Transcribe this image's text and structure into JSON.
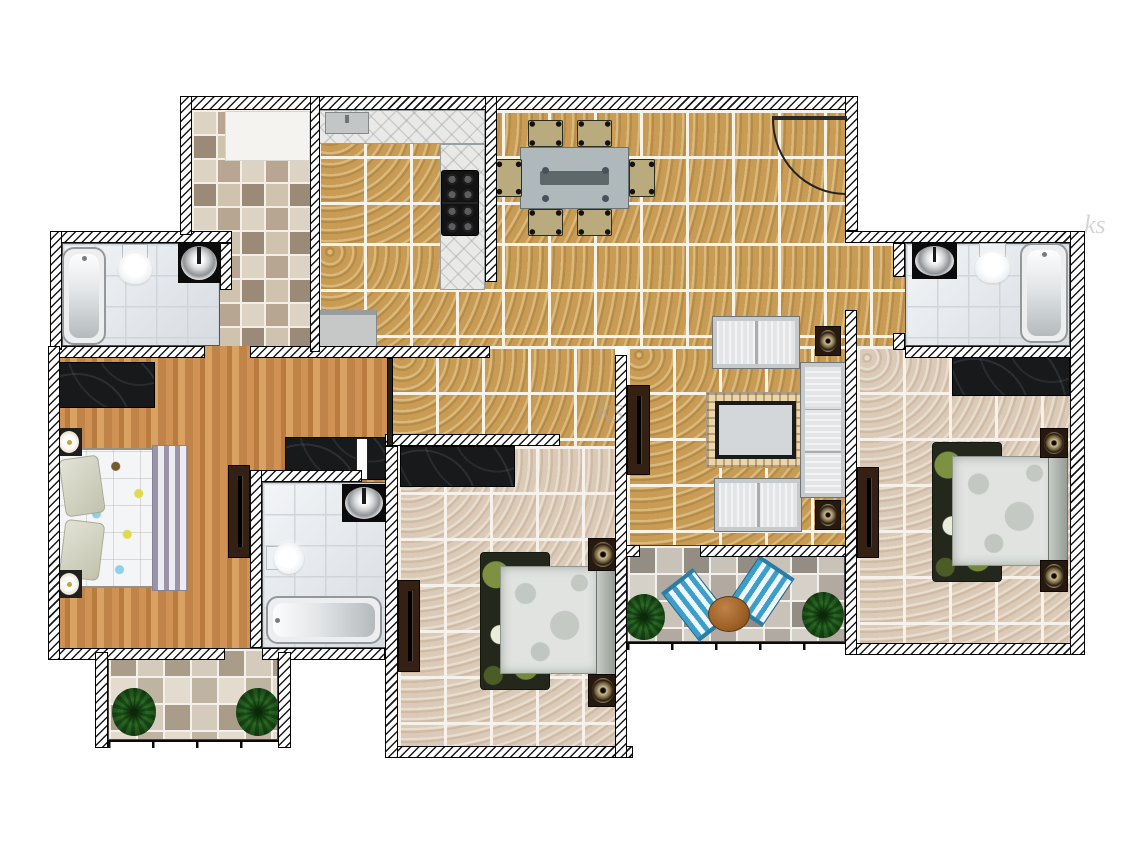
{
  "title": "apartment-floor-plan",
  "canvas": {
    "width": 1128,
    "height": 855,
    "background": "#ffffff"
  },
  "palette": {
    "tan_tile": "#c89c55",
    "beige_tile": "#dbcab7",
    "wood_floor": "#c08448",
    "bath_tile": "#e8ebee",
    "wall_black": "#000000",
    "rug_dark": "#17191b",
    "sofa_grey": "#c7cacc",
    "chair_khaki": "#b9ab7d",
    "lounge_blue": "#3c9ecb",
    "carpet_border_tan": "#ead6aa",
    "plant_green": "#2c6e27",
    "table_brown": "#9c5f27"
  },
  "watermarks": [
    {
      "text": "ks",
      "x": 596,
      "y": 392,
      "size": 34
    },
    {
      "text": "ks",
      "x": 1084,
      "y": 210,
      "size": 26
    }
  ],
  "elements": [
    {
      "n": "floor-foyer",
      "t": "mosaic-warm",
      "x": 192,
      "y": 110,
      "w": 118,
      "h": 236
    },
    {
      "n": "floor-kitchen-dining",
      "t": "tan",
      "x": 318,
      "y": 110,
      "w": 527,
      "h": 133
    },
    {
      "n": "floor-hallway-upper",
      "t": "tan",
      "x": 318,
      "y": 243,
      "w": 587,
      "h": 103
    },
    {
      "n": "floor-living-room",
      "t": "tan",
      "x": 627,
      "y": 346,
      "w": 218,
      "h": 199
    },
    {
      "n": "floor-corridor",
      "t": "tan",
      "x": 390,
      "y": 346,
      "w": 225,
      "h": 100
    },
    {
      "n": "floor-master-bedroom",
      "t": "wood",
      "x": 58,
      "y": 346,
      "w": 330,
      "h": 302
    },
    {
      "n": "floor-bathroom-left",
      "t": "bathtile",
      "x": 62,
      "y": 243,
      "w": 158,
      "h": 103
    },
    {
      "n": "floor-bathroom-ensuite",
      "t": "bathtile",
      "x": 262,
      "y": 482,
      "w": 126,
      "h": 166
    },
    {
      "n": "floor-bathroom-right",
      "t": "bathtile",
      "x": 905,
      "y": 243,
      "w": 165,
      "h": 103
    },
    {
      "n": "floor-bedroom-2",
      "t": "beige",
      "x": 398,
      "y": 446,
      "w": 217,
      "h": 300
    },
    {
      "n": "floor-bedroom-3",
      "t": "beige",
      "x": 857,
      "y": 346,
      "w": 213,
      "h": 297
    },
    {
      "n": "floor-balcony-left",
      "t": "mosaic-beige",
      "x": 108,
      "y": 648,
      "w": 170,
      "h": 92
    },
    {
      "n": "floor-balcony-center",
      "t": "mosaic-grey",
      "x": 627,
      "y": 545,
      "w": 218,
      "h": 97
    },
    {
      "n": "entrance-doormat",
      "t": "mat",
      "x": 225,
      "y": 111,
      "w": 85,
      "h": 50
    },
    {
      "n": "rug-master-bedroom",
      "t": "rug-dark",
      "x": 58,
      "y": 362,
      "w": 97,
      "h": 46
    },
    {
      "n": "rug-hallway",
      "t": "rug-dark",
      "x": 285,
      "y": 437,
      "w": 103,
      "h": 43
    },
    {
      "n": "rug-bedroom-2",
      "t": "rug-dark",
      "x": 400,
      "y": 446,
      "w": 115,
      "h": 41
    },
    {
      "n": "rug-bedroom-3",
      "t": "rug-dark",
      "x": 952,
      "y": 356,
      "w": 118,
      "h": 40
    },
    {
      "n": "carpet-bedroom-2",
      "t": "carpet-olive",
      "x": 480,
      "y": 552,
      "w": 70,
      "h": 138
    },
    {
      "n": "carpet-bedroom-3",
      "t": "carpet-olive",
      "x": 932,
      "y": 442,
      "w": 70,
      "h": 140
    },
    {
      "n": "carpet-living-room",
      "t": "carpet-greek",
      "x": 706,
      "y": 392,
      "w": 99,
      "h": 76
    },
    {
      "n": "kitchen-counter-top",
      "t": "counter",
      "x": 318,
      "y": 110,
      "w": 167,
      "h": 34
    },
    {
      "n": "kitchen-counter-right",
      "t": "counter",
      "x": 440,
      "y": 144,
      "w": 45,
      "h": 146
    },
    {
      "n": "gas-stove",
      "t": "stove",
      "x": 441,
      "y": 170,
      "w": 38,
      "h": 66
    },
    {
      "n": "kitchen-sink",
      "t": "sink-grey",
      "x": 325,
      "y": 112,
      "w": 44,
      "h": 22
    },
    {
      "n": "refrigerator",
      "t": "fridge",
      "x": 318,
      "y": 310,
      "w": 59,
      "h": 40
    },
    {
      "n": "dining-table",
      "t": "table-grey",
      "x": 520,
      "y": 147,
      "w": 109,
      "h": 62
    },
    {
      "n": "dining-chair-1",
      "t": "chair",
      "x": 528,
      "y": 120,
      "w": 35,
      "h": 27
    },
    {
      "n": "dining-chair-2",
      "t": "chair",
      "x": 577,
      "y": 120,
      "w": 35,
      "h": 27
    },
    {
      "n": "dining-chair-3",
      "t": "chair",
      "x": 528,
      "y": 209,
      "w": 35,
      "h": 27
    },
    {
      "n": "dining-chair-4",
      "t": "chair",
      "x": 577,
      "y": 209,
      "w": 35,
      "h": 27
    },
    {
      "n": "dining-chair-5",
      "t": "chair",
      "x": 496,
      "y": 159,
      "w": 26,
      "h": 38
    },
    {
      "n": "dining-chair-6",
      "t": "chair",
      "x": 629,
      "y": 159,
      "w": 26,
      "h": 38
    },
    {
      "n": "sofa-two-seater-top",
      "t": "sofa-h",
      "x": 712,
      "y": 316,
      "w": 88,
      "h": 53
    },
    {
      "n": "sofa-two-seater-bottom",
      "t": "sofa-h",
      "x": 714,
      "y": 478,
      "w": 88,
      "h": 54
    },
    {
      "n": "sofa-three-seater",
      "t": "sofa-v",
      "x": 800,
      "y": 362,
      "w": 46,
      "h": 136
    },
    {
      "n": "side-table-top",
      "t": "speaker-box",
      "x": 815,
      "y": 326,
      "w": 26,
      "h": 30
    },
    {
      "n": "side-table-bottom",
      "t": "speaker-box",
      "x": 815,
      "y": 500,
      "w": 26,
      "h": 30
    },
    {
      "n": "tv-unit-living-room",
      "t": "tvunit-v",
      "x": 627,
      "y": 385,
      "w": 23,
      "h": 90
    },
    {
      "n": "master-bed",
      "t": "bed-master",
      "x": 58,
      "y": 448,
      "w": 100,
      "h": 140
    },
    {
      "n": "master-bed-runner",
      "t": "runner-stripes",
      "x": 152,
      "y": 445,
      "w": 36,
      "h": 146
    },
    {
      "n": "master-bed-pillows",
      "t": "pillow-master",
      "x": 60,
      "y": 455,
      "w": 46,
      "h": 126
    },
    {
      "n": "wall-lamp-top",
      "t": "lamp-round",
      "x": 56,
      "y": 428,
      "w": 26,
      "h": 28
    },
    {
      "n": "wall-lamp-bottom",
      "t": "lamp-round",
      "x": 56,
      "y": 570,
      "w": 26,
      "h": 28
    },
    {
      "n": "wardrobe-master",
      "t": "tvunit-v",
      "x": 228,
      "y": 465,
      "w": 22,
      "h": 93
    },
    {
      "n": "bed-2",
      "t": "bed-grey",
      "x": 500,
      "y": 566,
      "w": 100,
      "h": 108
    },
    {
      "n": "headboard-bed-2",
      "t": "headboard-v",
      "x": 596,
      "y": 560,
      "w": 20,
      "h": 118
    },
    {
      "n": "nightstand-bed2-top",
      "t": "speaker-box",
      "x": 588,
      "y": 538,
      "w": 30,
      "h": 33
    },
    {
      "n": "nightstand-bed2-bottom",
      "t": "speaker-box",
      "x": 588,
      "y": 674,
      "w": 30,
      "h": 33
    },
    {
      "n": "wardrobe-bedroom-2",
      "t": "tvunit-v",
      "x": 398,
      "y": 580,
      "w": 22,
      "h": 92
    },
    {
      "n": "bed-3",
      "t": "bed-grey",
      "x": 952,
      "y": 456,
      "w": 104,
      "h": 110
    },
    {
      "n": "headboard-bed-3",
      "t": "headboard-v",
      "x": 1048,
      "y": 452,
      "w": 20,
      "h": 118
    },
    {
      "n": "nightstand-bed3-top",
      "t": "speaker-box",
      "x": 1040,
      "y": 428,
      "w": 28,
      "h": 30
    },
    {
      "n": "nightstand-bed3-bottom",
      "t": "speaker-box",
      "x": 1040,
      "y": 560,
      "w": 28,
      "h": 32
    },
    {
      "n": "wardrobe-bedroom-3",
      "t": "tvunit-v",
      "x": 857,
      "y": 467,
      "w": 22,
      "h": 91
    },
    {
      "n": "bathtub-left",
      "t": "tub-v",
      "x": 62,
      "y": 247,
      "w": 44,
      "h": 98
    },
    {
      "n": "toilet-left",
      "t": "toilet-v",
      "x": 118,
      "y": 244,
      "w": 34,
      "h": 40
    },
    {
      "n": "washbasin-left",
      "t": "sink-sq",
      "x": 178,
      "y": 243,
      "w": 42,
      "h": 40
    },
    {
      "n": "toilet-ensuite",
      "t": "toilet-h",
      "x": 266,
      "y": 542,
      "w": 38,
      "h": 32
    },
    {
      "n": "bathtub-ensuite",
      "t": "tub-h",
      "x": 266,
      "y": 596,
      "w": 116,
      "h": 48
    },
    {
      "n": "washbasin-ensuite",
      "t": "sink-sq",
      "x": 342,
      "y": 484,
      "w": 44,
      "h": 38
    },
    {
      "n": "washbasin-right",
      "t": "sink-sq",
      "x": 912,
      "y": 243,
      "w": 45,
      "h": 36
    },
    {
      "n": "toilet-right",
      "t": "toilet-v",
      "x": 975,
      "y": 243,
      "w": 35,
      "h": 40
    },
    {
      "n": "bathtub-right",
      "t": "tub-v",
      "x": 1020,
      "y": 243,
      "w": 48,
      "h": 100
    },
    {
      "n": "plant-balcony-left-1",
      "t": "plant",
      "x": 112,
      "y": 688,
      "w": 44,
      "h": 48
    },
    {
      "n": "plant-balcony-left-2",
      "t": "plant",
      "x": 236,
      "y": 688,
      "w": 44,
      "h": 48
    },
    {
      "n": "plant-balcony-center-1",
      "t": "plant",
      "x": 623,
      "y": 594,
      "w": 42,
      "h": 46
    },
    {
      "n": "plant-balcony-center-2",
      "t": "plant",
      "x": 802,
      "y": 592,
      "w": 42,
      "h": 46
    },
    {
      "n": "lounge-chair-1",
      "t": "lounge",
      "x": 676,
      "y": 574,
      "w": 40,
      "h": 62,
      "r": -38
    },
    {
      "n": "lounge-chair-2",
      "t": "lounge",
      "x": 740,
      "y": 562,
      "w": 42,
      "h": 58,
      "r": 34
    },
    {
      "n": "balcony-round-table",
      "t": "round-table",
      "x": 708,
      "y": 596,
      "w": 42,
      "h": 36
    },
    {
      "n": "door-ensuite",
      "t": "door-white-v",
      "x": 356,
      "y": 438,
      "w": 12,
      "h": 42
    },
    {
      "n": "wall-top",
      "t": "hatch",
      "x": 180,
      "y": 96,
      "w": 677,
      "h": 14
    },
    {
      "n": "wall-bath-left-top",
      "t": "hatch",
      "x": 50,
      "y": 231,
      "w": 182,
      "h": 12
    },
    {
      "n": "wall-right-wing-top",
      "t": "hatch",
      "x": 845,
      "y": 231,
      "w": 240,
      "h": 12
    },
    {
      "n": "wall-master-top-left",
      "t": "hatch",
      "x": 50,
      "y": 346,
      "w": 155,
      "h": 12
    },
    {
      "n": "wall-kitchen-bottom",
      "t": "hatch",
      "x": 250,
      "y": 346,
      "w": 240,
      "h": 12
    },
    {
      "n": "wall-bedroom3-top",
      "t": "hatch",
      "x": 905,
      "y": 346,
      "w": 180,
      "h": 12
    },
    {
      "n": "wall-bedroom2-top",
      "t": "hatch",
      "x": 385,
      "y": 434,
      "w": 175,
      "h": 12
    },
    {
      "n": "wall-ensuite-top",
      "t": "hatch",
      "x": 250,
      "y": 470,
      "w": 112,
      "h": 12
    },
    {
      "n": "wall-living-bottom-a",
      "t": "hatch",
      "x": 618,
      "y": 545,
      "w": 22,
      "h": 12
    },
    {
      "n": "wall-living-bottom-b",
      "t": "hatch",
      "x": 700,
      "y": 545,
      "w": 147,
      "h": 12
    },
    {
      "n": "wall-master-bottom-a",
      "t": "hatch",
      "x": 48,
      "y": 648,
      "w": 177,
      "h": 12
    },
    {
      "n": "wall-master-bottom-b",
      "t": "hatch",
      "x": 262,
      "y": 648,
      "w": 123,
      "h": 12
    },
    {
      "n": "wall-bedroom2-bottom",
      "t": "hatch",
      "x": 385,
      "y": 746,
      "w": 248,
      "h": 12
    },
    {
      "n": "wall-bedroom3-bottom",
      "t": "hatch",
      "x": 845,
      "y": 643,
      "w": 240,
      "h": 12
    },
    {
      "n": "wall-foyer-left",
      "t": "hatch",
      "x": 180,
      "y": 96,
      "w": 12,
      "h": 139
    },
    {
      "n": "wall-bath-left-side",
      "t": "hatch",
      "x": 50,
      "y": 231,
      "w": 12,
      "h": 119
    },
    {
      "n": "wall-master-left",
      "t": "hatch",
      "x": 48,
      "y": 346,
      "w": 12,
      "h": 314
    },
    {
      "n": "wall-foyer-kitchen",
      "t": "hatch",
      "x": 310,
      "y": 96,
      "w": 10,
      "h": 256
    },
    {
      "n": "wall-kitchen-right",
      "t": "hatch",
      "x": 485,
      "y": 96,
      "w": 12,
      "h": 186
    },
    {
      "n": "wall-entry-right",
      "t": "hatch",
      "x": 845,
      "y": 96,
      "w": 13,
      "h": 135
    },
    {
      "n": "wall-living-right",
      "t": "hatch",
      "x": 845,
      "y": 310,
      "w": 12,
      "h": 345
    },
    {
      "n": "wall-bath-right-left-a",
      "t": "hatch",
      "x": 893,
      "y": 243,
      "w": 12,
      "h": 34
    },
    {
      "n": "wall-bath-right-left-b",
      "t": "hatch",
      "x": 893,
      "y": 333,
      "w": 12,
      "h": 17
    },
    {
      "n": "wall-right-exterior",
      "t": "hatch",
      "x": 1070,
      "y": 231,
      "w": 15,
      "h": 424
    },
    {
      "n": "wall-corridor-right",
      "t": "hatch",
      "x": 615,
      "y": 355,
      "w": 12,
      "h": 403
    },
    {
      "n": "wall-bedroom2-left",
      "t": "hatch",
      "x": 385,
      "y": 446,
      "w": 13,
      "h": 312
    },
    {
      "n": "wall-ensuite-left",
      "t": "hatch",
      "x": 250,
      "y": 470,
      "w": 12,
      "h": 178
    },
    {
      "n": "wall-bath-foyer",
      "t": "hatch",
      "x": 220,
      "y": 243,
      "w": 12,
      "h": 47
    },
    {
      "n": "wall-master-east",
      "t": "solidwall",
      "x": 387,
      "y": 358,
      "w": 6,
      "h": 88
    },
    {
      "n": "wall-balcony-left-a",
      "t": "hatch",
      "x": 95,
      "y": 652,
      "w": 13,
      "h": 96
    },
    {
      "n": "wall-balcony-left-b",
      "t": "hatch",
      "x": 278,
      "y": 652,
      "w": 13,
      "h": 96
    },
    {
      "n": "railing-balcony-left",
      "t": "railing",
      "x": 108,
      "y": 740,
      "w": 170,
      "h": 8
    },
    {
      "n": "railing-balcony-center",
      "t": "railing",
      "x": 627,
      "y": 642,
      "w": 218,
      "h": 8
    },
    {
      "n": "main-entrance-door-leaf",
      "t": "line-h",
      "x": 772,
      "y": 116,
      "w": 75,
      "h": 4
    },
    {
      "n": "main-entrance-door-arc",
      "t": "door-arc",
      "x": 772,
      "y": 119,
      "w": 74,
      "h": 76
    }
  ]
}
